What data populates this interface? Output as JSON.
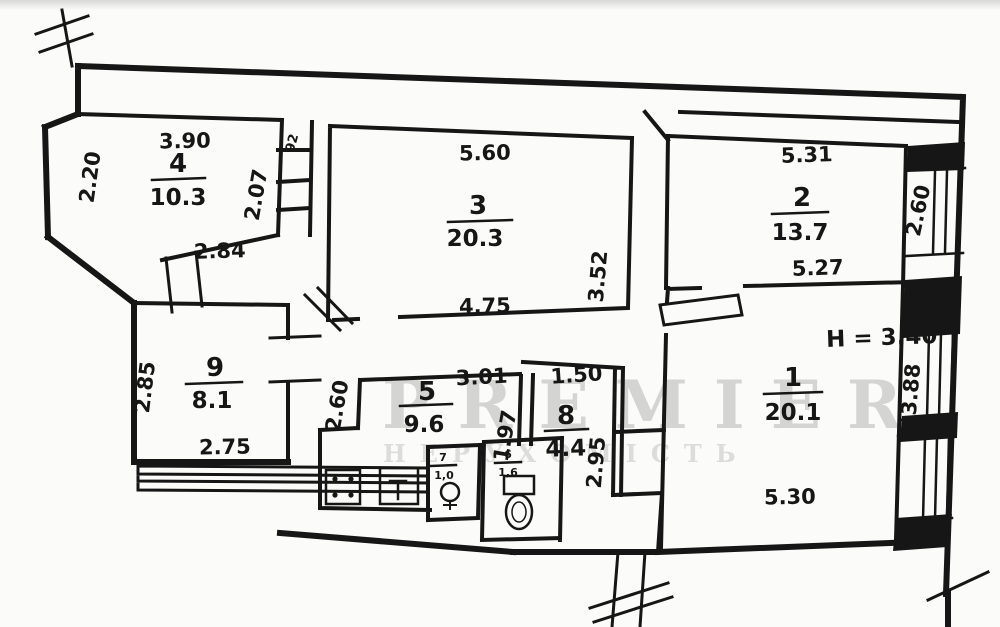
{
  "document": {
    "type": "apartment floor plan (scanned hand-drawn BTI plan)",
    "ink_color": "#161616",
    "paper_color": "#fbfbf9"
  },
  "watermark": {
    "line1": "PREMIER",
    "line2": "НЕРУХОМІСТЬ"
  },
  "annotations": {
    "ceiling_height": "H = 3.40",
    "shaft_width": "92"
  },
  "rooms": [
    {
      "number": "1",
      "area": "20.1",
      "dim_bottom": "5.30",
      "dim_right": "3.88"
    },
    {
      "number": "2",
      "area": "13.7",
      "dim_top": "5.31",
      "dim_bottom": "5.27",
      "dim_right": "2.60"
    },
    {
      "number": "3",
      "area": "20.3",
      "dim_top": "5.60",
      "dim_bottom": "4.75",
      "dim_right": "3.52",
      "dim_left": "2.07"
    },
    {
      "number": "4",
      "area": "10.3",
      "dim_top": "3.90",
      "dim_left": "2.20",
      "dim_bottom": "2.84"
    },
    {
      "number": "5",
      "area": "9.6",
      "dim_top": "3.01",
      "dim_left": "2.60",
      "dim_right": "1.97"
    },
    {
      "number": "6",
      "area": "1,6"
    },
    {
      "number": "7",
      "area": "1,0"
    },
    {
      "number": "8",
      "area": "4.4",
      "dim_top": "1.50",
      "dim_right": "2.95"
    },
    {
      "number": "9",
      "area": "8.1",
      "dim_left": "2.85",
      "dim_bottom": "2.75"
    }
  ]
}
